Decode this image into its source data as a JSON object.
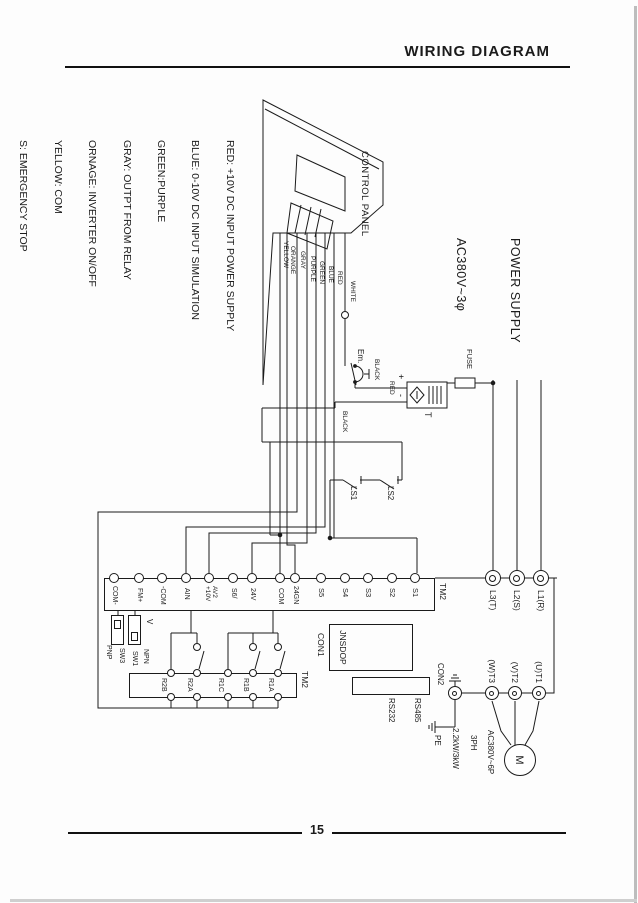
{
  "page": {
    "header_title": "WIRING  DIAGRAM",
    "page_number": "15"
  },
  "diagram": {
    "power_supply": {
      "title": "POWER SUPPLY",
      "voltage": "AC380V~3φ"
    },
    "power_terminals": [
      "L1(R)",
      "L2(S)",
      "L3(T)"
    ],
    "control_panel_label": "CONTROL PANEL",
    "panel_wires": [
      "RED",
      "BLUE",
      "GREEN",
      "PURPLE",
      "GRAY",
      "ORANGE",
      "YELLOW"
    ],
    "dc_circuit": {
      "white": "WHITE",
      "em": "Em.",
      "plus": "+",
      "minus": "-",
      "red": "RED",
      "black_upper": "BLACK",
      "black_lower": "BLACK",
      "transformer": "T",
      "fuse": "FUSE"
    },
    "legend": [
      "RED: +10V DC INPUT POWER SUPPLY",
      "BLUE: 0-10V DC INPUT SIMULATION",
      "GREEN:PURPLE",
      "GRAY: OUTPT FROM RELAY",
      "ORNAGE: INVERTER ON/OFF",
      "YELLOW: COM",
      "S: EMERGENCY STOP",
      "LS1: SAFETY GUARD LIMIT SWITCH",
      "LS2: BOWL POSITION LIMIT SWITCH"
    ],
    "limit_switches": {
      "ls1": "LS1",
      "ls2": "LS2"
    },
    "terminal_strip": {
      "name": "TM2",
      "terminals": [
        "S1",
        "S2",
        "S3",
        "S4",
        "S5",
        "24GN",
        "COM",
        "24V",
        "S6/",
        "AV2\n+10V",
        "AIN",
        "-COM",
        "FM+",
        "COM-"
      ]
    },
    "relay_block": {
      "name": "TM2",
      "contacts": [
        "R1A",
        "R1B",
        "R1C",
        "R2A",
        "R2B"
      ]
    },
    "dip_switches": {
      "v": "V",
      "npn": "NPN",
      "sw1": "SW1",
      "sw3": "SW3",
      "pnp": "PNP"
    },
    "connectors": {
      "con1": "CON1",
      "con1_label": "JNSDOP",
      "con2": "CON2",
      "rs485": "RS485",
      "rs232": "RS232",
      "pe": "PE"
    },
    "output_terminals": [
      "(U)T1",
      "(V)T2",
      "(W)T3"
    ],
    "motor": {
      "symbol": "M",
      "spec1": "AC380V~6P",
      "spec2": "3PH",
      "spec3": "2.2kW/3kW"
    }
  }
}
